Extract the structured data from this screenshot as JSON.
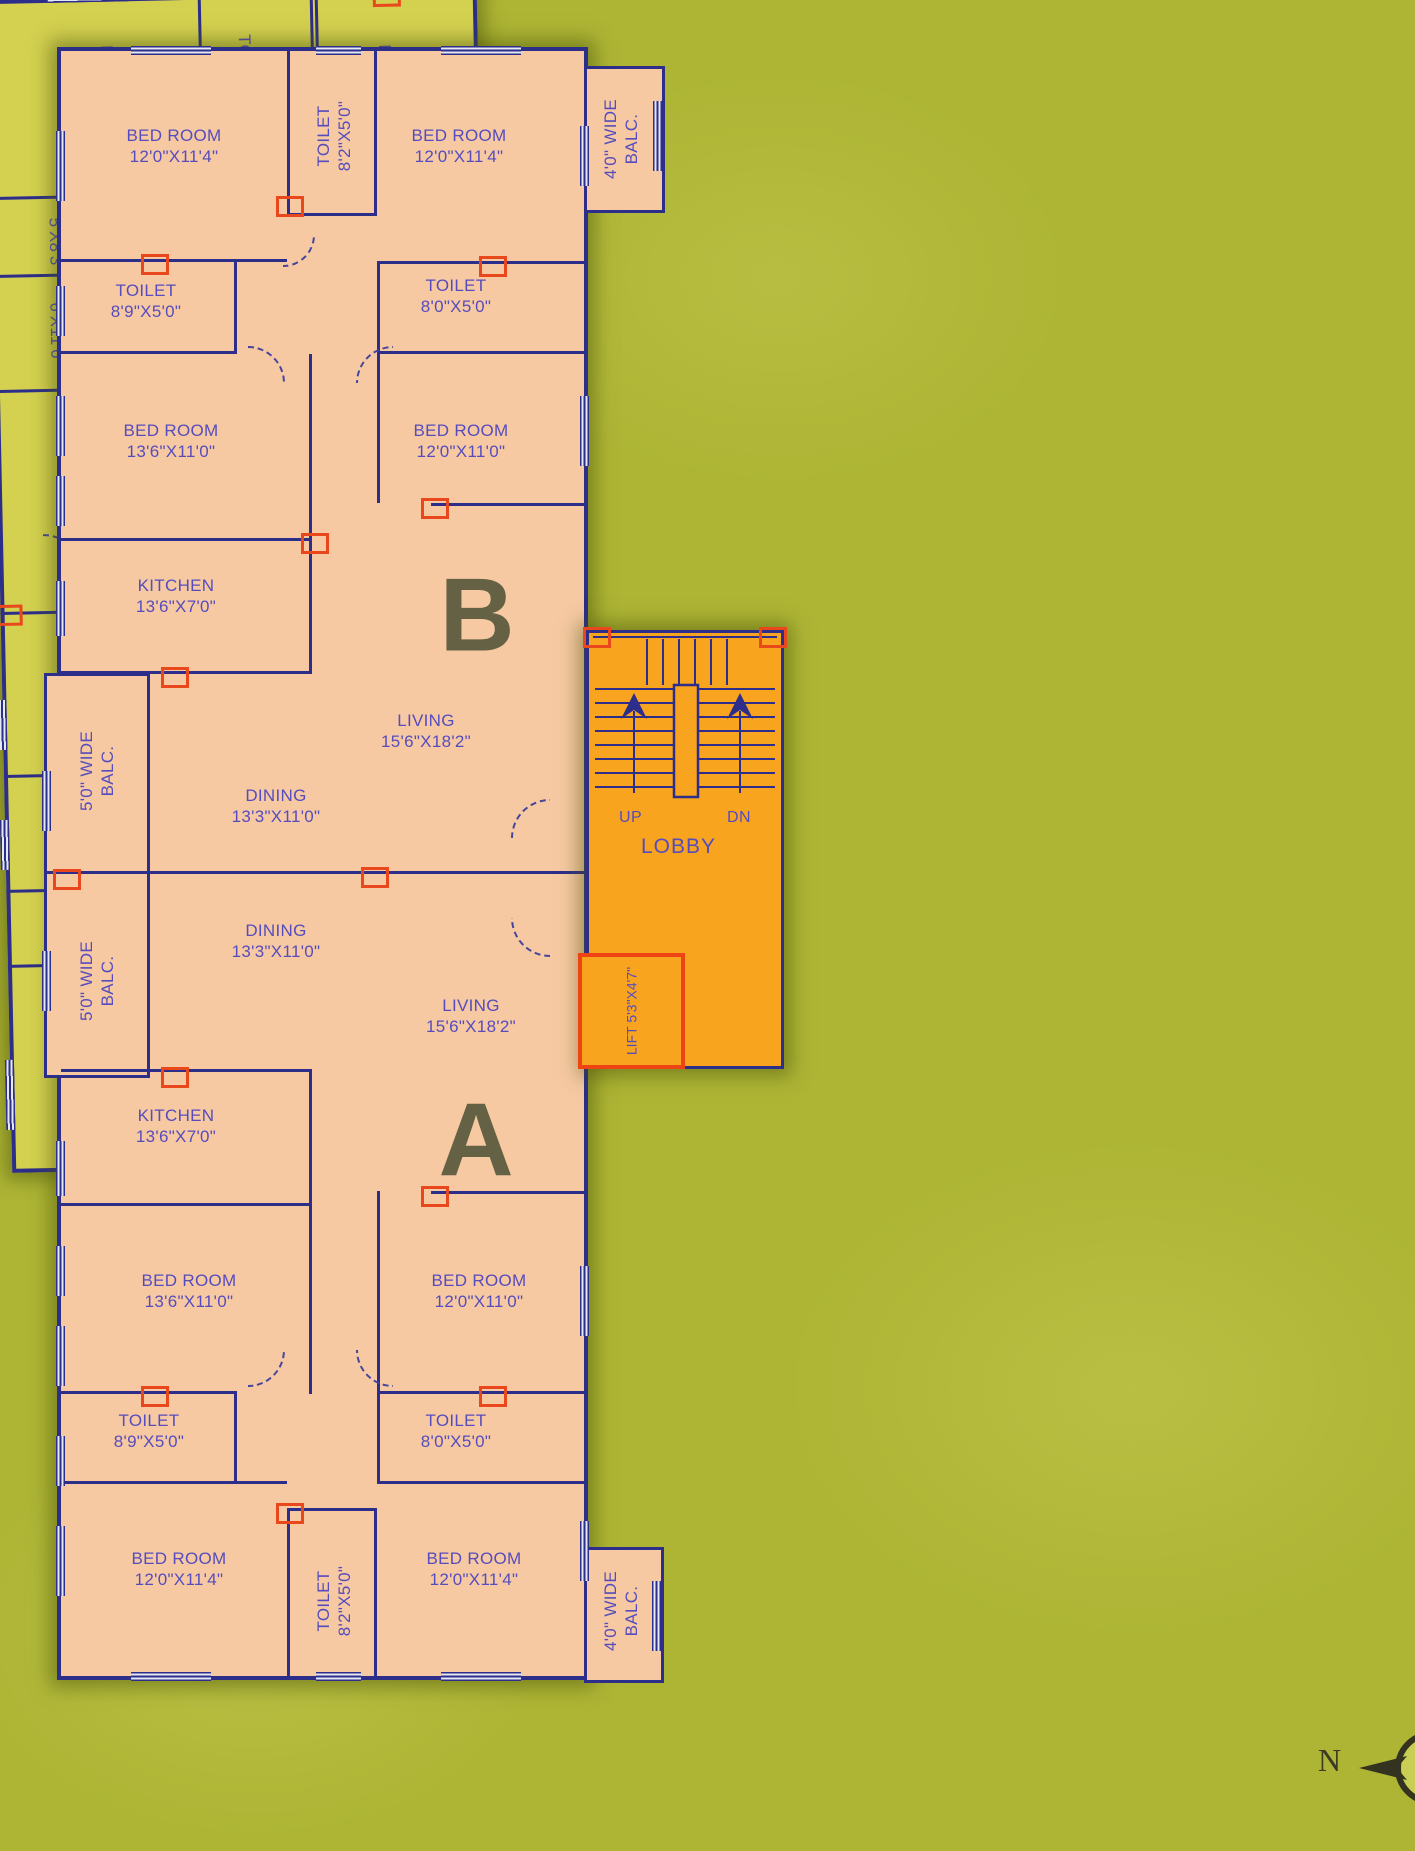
{
  "canvas": {
    "width": 1415,
    "height": 1851
  },
  "colors": {
    "background": "#aeb535",
    "building_ab_fill": "#f6c9a2",
    "building_cd_fill": "#d4d150",
    "lobby_fill": "#f8a41e",
    "wall": "#2d2d8a",
    "label_text": "#564cbe",
    "unit_letter": "#58583c",
    "accent_red": "#e8481c",
    "lift_border": "#ee4312"
  },
  "compass": {
    "label": "N"
  },
  "lobby": {
    "label": "LOBBY",
    "up_label": "UP",
    "dn_label": "DN",
    "lift": {
      "name": "LIFT",
      "size": "5'3\"X4'7\""
    }
  },
  "units": [
    {
      "letter": "B",
      "parent": "ab",
      "x": 416,
      "y": 565
    },
    {
      "letter": "A",
      "parent": "ab",
      "x": 415,
      "y": 1090
    },
    {
      "letter": "C",
      "parent": "cd",
      "x": 247,
      "y": 495
    },
    {
      "letter": "D",
      "parent": "cd",
      "x": 244,
      "y": 677
    }
  ],
  "rooms": [
    {
      "parent": "ab",
      "name": "BED ROOM",
      "size": "12'0\"X11'4\"",
      "x": 113,
      "y": 95,
      "rot": "h"
    },
    {
      "parent": "ab",
      "name": "TOILET",
      "size": "8'2\"X5'0\"",
      "x": 273,
      "y": 85,
      "rot": "ccw"
    },
    {
      "parent": "ab",
      "name": "BED ROOM",
      "size": "12'0\"X11'4\"",
      "x": 398,
      "y": 95,
      "rot": "h"
    },
    {
      "parent": "ab",
      "name": "4'0\" WIDE",
      "size": "BALC.",
      "x": 560,
      "y": 88,
      "rot": "ccw"
    },
    {
      "parent": "ab",
      "name": "TOILET",
      "size": "8'9\"X5'0\"",
      "x": 85,
      "y": 250,
      "rot": "h"
    },
    {
      "parent": "ab",
      "name": "TOILET",
      "size": "8'0\"X5'0\"",
      "x": 395,
      "y": 245,
      "rot": "h"
    },
    {
      "parent": "ab",
      "name": "BED ROOM",
      "size": "13'6\"X11'0\"",
      "x": 110,
      "y": 390,
      "rot": "h"
    },
    {
      "parent": "ab",
      "name": "BED ROOM",
      "size": "12'0\"X11'0\"",
      "x": 400,
      "y": 390,
      "rot": "h"
    },
    {
      "parent": "ab",
      "name": "KITCHEN",
      "size": "13'6\"X7'0\"",
      "x": 115,
      "y": 545,
      "rot": "h"
    },
    {
      "parent": "ab",
      "name": "LIVING",
      "size": "15'6\"X18'2\"",
      "x": 365,
      "y": 680,
      "rot": "h"
    },
    {
      "parent": "ab",
      "name": "DINING",
      "size": "13'3\"X11'0\"",
      "x": 215,
      "y": 755,
      "rot": "h"
    },
    {
      "parent": "ab",
      "name": "5'0\" WIDE",
      "size": "BALC.",
      "x": 36,
      "y": 720,
      "rot": "ccw"
    },
    {
      "parent": "ab",
      "name": "DINING",
      "size": "13'3\"X11'0\"",
      "x": 215,
      "y": 890,
      "rot": "h"
    },
    {
      "parent": "ab",
      "name": "5'0\" WIDE",
      "size": "BALC.",
      "x": 36,
      "y": 930,
      "rot": "ccw"
    },
    {
      "parent": "ab",
      "name": "LIVING",
      "size": "15'6\"X18'2\"",
      "x": 410,
      "y": 965,
      "rot": "h"
    },
    {
      "parent": "ab",
      "name": "KITCHEN",
      "size": "13'6\"X7'0\"",
      "x": 115,
      "y": 1075,
      "rot": "h"
    },
    {
      "parent": "ab",
      "name": "BED ROOM",
      "size": "13'6\"X11'0\"",
      "x": 128,
      "y": 1240,
      "rot": "h"
    },
    {
      "parent": "ab",
      "name": "BED ROOM",
      "size": "12'0\"X11'0\"",
      "x": 418,
      "y": 1240,
      "rot": "h"
    },
    {
      "parent": "ab",
      "name": "TOILET",
      "size": "8'9\"X5'0\"",
      "x": 88,
      "y": 1380,
      "rot": "h"
    },
    {
      "parent": "ab",
      "name": "TOILET",
      "size": "8'0\"X5'0\"",
      "x": 395,
      "y": 1380,
      "rot": "h"
    },
    {
      "parent": "ab",
      "name": "BED ROOM",
      "size": "12'0\"X11'4\"",
      "x": 118,
      "y": 1518,
      "rot": "h"
    },
    {
      "parent": "ab",
      "name": "TOILET",
      "size": "8'2\"X5'0\"",
      "x": 273,
      "y": 1550,
      "rot": "ccw"
    },
    {
      "parent": "ab",
      "name": "BED ROOM",
      "size": "12'0\"X11'4\"",
      "x": 413,
      "y": 1518,
      "rot": "h"
    },
    {
      "parent": "ab",
      "name": "4'0\" WIDE",
      "size": "BALC.",
      "x": 560,
      "y": 1560,
      "rot": "ccw"
    },
    {
      "parent": "cd",
      "name": "BED ROOM",
      "size": "11'0\"X11'6\"",
      "x": 107,
      "y": 95,
      "rot": "cw"
    },
    {
      "parent": "cd",
      "name": "TOILET",
      "size": "8'X4'",
      "x": 245,
      "y": 70,
      "rot": "cw"
    },
    {
      "parent": "cd",
      "name": "BED ROOM",
      "size": "11'2\"X12'2\"",
      "x": 385,
      "y": 100,
      "rot": "cw"
    },
    {
      "parent": "cd",
      "name": "TOILET",
      "size": "5'X8'3\"",
      "x": 73,
      "y": 246,
      "rot": "cw"
    },
    {
      "parent": "cd",
      "name": "KITCHEN",
      "size": "6'X11'6\"",
      "x": 72,
      "y": 335,
      "rot": "cw"
    },
    {
      "parent": "cd",
      "name": "BED ROOM",
      "size": "11'2\"X13'2\"",
      "x": 392,
      "y": 300,
      "rot": "cw"
    },
    {
      "parent": "cd",
      "name": "DINING",
      "size": "11'0\"X11'8\"",
      "x": 127,
      "y": 498,
      "rot": "cw"
    },
    {
      "parent": "cd",
      "name": "LIVING",
      "size": "11'0\"X13'7\"",
      "x": 365,
      "y": 500,
      "rot": "cw"
    },
    {
      "parent": "cd",
      "name": "4'3\" W.",
      "size": "BALC.",
      "x": 472,
      "y": 497,
      "rot": "cw"
    },
    {
      "parent": "cd",
      "name": "DINING",
      "size": "11'0\"X11'8\"",
      "x": 115,
      "y": 676,
      "rot": "cw"
    },
    {
      "parent": "cd",
      "name": "LIVING",
      "size": "11'0\"X13'7\"",
      "x": 339,
      "y": 688,
      "rot": "cw"
    },
    {
      "parent": "cd",
      "name": "4'3\" W.",
      "size": "BALC.",
      "x": 472,
      "y": 686,
      "rot": "cw"
    },
    {
      "parent": "cd",
      "name": "KITCHEN",
      "size": "6'X11'6\"",
      "x": 72,
      "y": 838,
      "rot": "cw"
    },
    {
      "parent": "cd",
      "name": "TOILET",
      "size": "5'X8'3\"",
      "x": 73,
      "y": 930,
      "rot": "cw"
    },
    {
      "parent": "cd",
      "name": "BED ROOM",
      "size": "11'0\"X11'6\"",
      "x": 107,
      "y": 1080,
      "rot": "cw"
    },
    {
      "parent": "cd",
      "name": "TOILET",
      "size": "8'X4'",
      "x": 242,
      "y": 1100,
      "rot": "cw"
    },
    {
      "parent": "cd",
      "name": "BED ROOM",
      "size": "11'2\"X13'2\"",
      "x": 385,
      "y": 885,
      "rot": "cw"
    },
    {
      "parent": "cd",
      "name": "BED ROOM",
      "size": "11'2\"X12'2\"",
      "x": 385,
      "y": 1078,
      "rot": "cw"
    }
  ]
}
